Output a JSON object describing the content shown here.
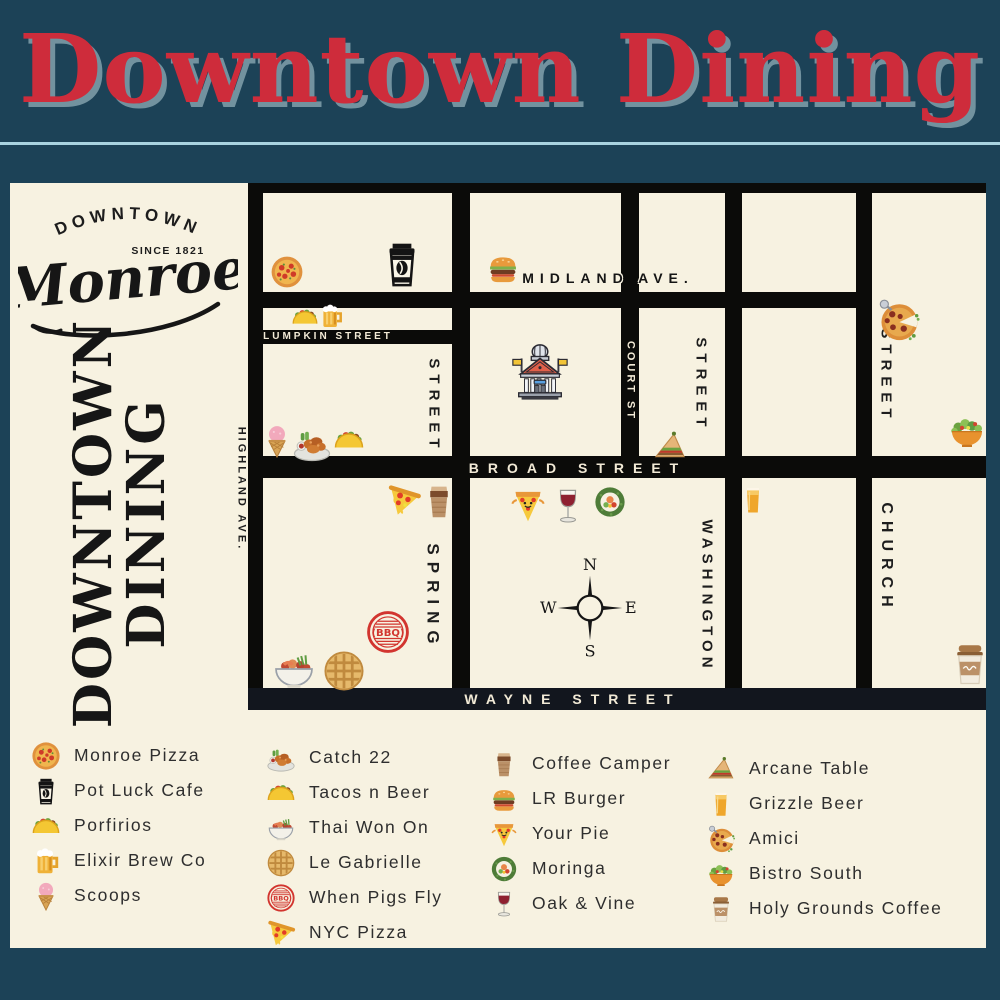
{
  "title": "Downtown Dining",
  "colors": {
    "background": "#1c4257",
    "panel": "#f7f2e1",
    "street": "#0b0b09",
    "title_red": "#ce2c3b",
    "title_shadow": "#72929f",
    "divider": "#a9d3e0",
    "bbq_red": "#d2352f"
  },
  "logo": {
    "arc_text": "DOWNTOWN",
    "since_text": "SINCE 1821",
    "script_text": "Monroe"
  },
  "sidebar_title": {
    "line1": "DOWNTOWN",
    "line2": "DINING"
  },
  "map": {
    "compass": {
      "n": "N",
      "e": "E",
      "s": "S",
      "w": "W"
    },
    "street_labels": [
      {
        "id": "midland-ave",
        "text": "MIDLAND AVE.",
        "x": 608,
        "y": 278,
        "vertical": false,
        "style": "on-cream-outline",
        "size": 14,
        "ls": 6
      },
      {
        "id": "lumpkin-street",
        "text": "LUMPKIN STREET",
        "x": 328,
        "y": 337,
        "vertical": false,
        "style": "on-black",
        "size": 10,
        "ls": 3
      },
      {
        "id": "broad-street",
        "text": "BROAD STREET",
        "x": 578,
        "y": 468,
        "vertical": false,
        "style": "on-black",
        "size": 14,
        "ls": 9
      },
      {
        "id": "wayne-street",
        "text": "WAYNE STREET",
        "x": 573,
        "y": 699,
        "vertical": false,
        "style": "on-black",
        "size": 14,
        "ls": 9
      },
      {
        "id": "court-st",
        "text": "COURT ST",
        "x": 630,
        "y": 381,
        "vertical": true,
        "style": "on-black",
        "size": 11,
        "ls": 3
      },
      {
        "id": "spring-street-upper",
        "text": "STREET",
        "x": 434,
        "y": 406,
        "vertical": true,
        "style": "on-cream",
        "size": 15,
        "ls": 6
      },
      {
        "id": "spring-street",
        "text": "SPRING",
        "x": 433,
        "y": 597,
        "vertical": true,
        "style": "on-cream",
        "size": 17,
        "ls": 7
      },
      {
        "id": "washington-street-upper",
        "text": "STREET",
        "x": 701,
        "y": 385,
        "vertical": true,
        "style": "on-cream",
        "size": 15,
        "ls": 6
      },
      {
        "id": "washington-street",
        "text": "WASHINGTON",
        "x": 707,
        "y": 596,
        "vertical": true,
        "style": "on-cream",
        "size": 15,
        "ls": 5
      },
      {
        "id": "church-street-upper",
        "text": "STREET",
        "x": 886,
        "y": 376,
        "vertical": true,
        "style": "on-cream",
        "size": 15,
        "ls": 6
      },
      {
        "id": "church-street",
        "text": "CHURCH",
        "x": 886,
        "y": 558,
        "vertical": true,
        "style": "on-cream",
        "size": 16,
        "ls": 7
      },
      {
        "id": "highland-ave",
        "text": "HIGHLAND AVE.",
        "x": 241,
        "y": 489,
        "vertical": true,
        "style": "on-cream",
        "size": 11,
        "ls": 3
      }
    ],
    "markers": [
      {
        "name": "monroe-pizza",
        "icon": "whole-pizza",
        "x": 287,
        "y": 272,
        "size": 34
      },
      {
        "name": "pot-luck-cafe",
        "icon": "potluck-cup",
        "x": 402,
        "y": 264,
        "size": 50
      },
      {
        "name": "porfirios",
        "icon": "taco",
        "x": 305,
        "y": 317,
        "size": 28
      },
      {
        "name": "elixir-brew-co",
        "icon": "beer-mug",
        "x": 331,
        "y": 316,
        "size": 27
      },
      {
        "name": "scoops",
        "icon": "icecream",
        "x": 277,
        "y": 441,
        "size": 34
      },
      {
        "name": "catch-22",
        "icon": "wings-plate",
        "x": 312,
        "y": 443,
        "size": 40
      },
      {
        "name": "tacos-n-beer",
        "icon": "taco",
        "x": 349,
        "y": 440,
        "size": 32
      },
      {
        "name": "lr-burger",
        "icon": "burger",
        "x": 503,
        "y": 268,
        "size": 36
      },
      {
        "name": "courthouse",
        "icon": "courthouse",
        "x": 540,
        "y": 372,
        "size": 62
      },
      {
        "name": "arcane-table",
        "icon": "sandwich",
        "x": 670,
        "y": 446,
        "size": 36
      },
      {
        "name": "amici",
        "icon": "amici-pizza",
        "x": 898,
        "y": 320,
        "size": 46
      },
      {
        "name": "bistro-south",
        "icon": "salad-bowl",
        "x": 967,
        "y": 431,
        "size": 40
      },
      {
        "name": "nyc-pizza",
        "icon": "nyc-slice",
        "x": 404,
        "y": 500,
        "size": 36
      },
      {
        "name": "coffee-camper",
        "icon": "camper-cup",
        "x": 439,
        "y": 501,
        "size": 40
      },
      {
        "name": "your-pie",
        "icon": "yourpie-slice",
        "x": 528,
        "y": 505,
        "size": 40
      },
      {
        "name": "oak-and-vine",
        "icon": "wine-glass",
        "x": 568,
        "y": 506,
        "size": 40
      },
      {
        "name": "moringa",
        "icon": "sushi",
        "x": 610,
        "y": 502,
        "size": 36
      },
      {
        "name": "grizzle-beer",
        "icon": "beer-glass",
        "x": 753,
        "y": 500,
        "size": 32
      },
      {
        "name": "when-pigs-fly",
        "icon": "bbq-stamp",
        "x": 388,
        "y": 632,
        "size": 46
      },
      {
        "name": "thai-won-on",
        "icon": "thai-bowl",
        "x": 294,
        "y": 669,
        "size": 46
      },
      {
        "name": "le-gabrielle",
        "icon": "waffle",
        "x": 344,
        "y": 671,
        "size": 44
      },
      {
        "name": "holy-grounds-coffee",
        "icon": "holy-cup",
        "x": 970,
        "y": 664,
        "size": 48
      }
    ]
  },
  "legend": {
    "columns": [
      {
        "x": 31,
        "y": 738,
        "items": [
          {
            "icon": "whole-pizza",
            "label": "Monroe Pizza"
          },
          {
            "icon": "potluck-cup",
            "label": "Pot Luck Cafe"
          },
          {
            "icon": "taco",
            "label": "Porfirios"
          },
          {
            "icon": "beer-mug",
            "label": "Elixir Brew Co"
          },
          {
            "icon": "icecream",
            "label": "Scoops"
          }
        ]
      },
      {
        "x": 266,
        "y": 740,
        "items": [
          {
            "icon": "wings-plate",
            "label": "Catch 22"
          },
          {
            "icon": "taco",
            "label": "Tacos n Beer"
          },
          {
            "icon": "thai-bowl",
            "label": "Thai Won On"
          },
          {
            "icon": "waffle",
            "label": "Le Gabrielle"
          },
          {
            "icon": "bbq-stamp",
            "label": "When Pigs Fly"
          },
          {
            "icon": "nyc-slice",
            "label": "NYC Pizza"
          }
        ]
      },
      {
        "x": 489,
        "y": 746,
        "items": [
          {
            "icon": "camper-cup",
            "label": "Coffee Camper"
          },
          {
            "icon": "burger",
            "label": "LR Burger"
          },
          {
            "icon": "yourpie-slice",
            "label": "Your Pie"
          },
          {
            "icon": "sushi",
            "label": "Moringa"
          },
          {
            "icon": "wine-glass",
            "label": "Oak & Vine"
          }
        ]
      },
      {
        "x": 706,
        "y": 751,
        "items": [
          {
            "icon": "sandwich",
            "label": "Arcane Table"
          },
          {
            "icon": "beer-glass",
            "label": "Grizzle Beer"
          },
          {
            "icon": "amici-pizza",
            "label": "Amici"
          },
          {
            "icon": "salad-bowl",
            "label": "Bistro South"
          },
          {
            "icon": "holy-cup",
            "label": "Holy Grounds Coffee"
          }
        ]
      }
    ]
  }
}
